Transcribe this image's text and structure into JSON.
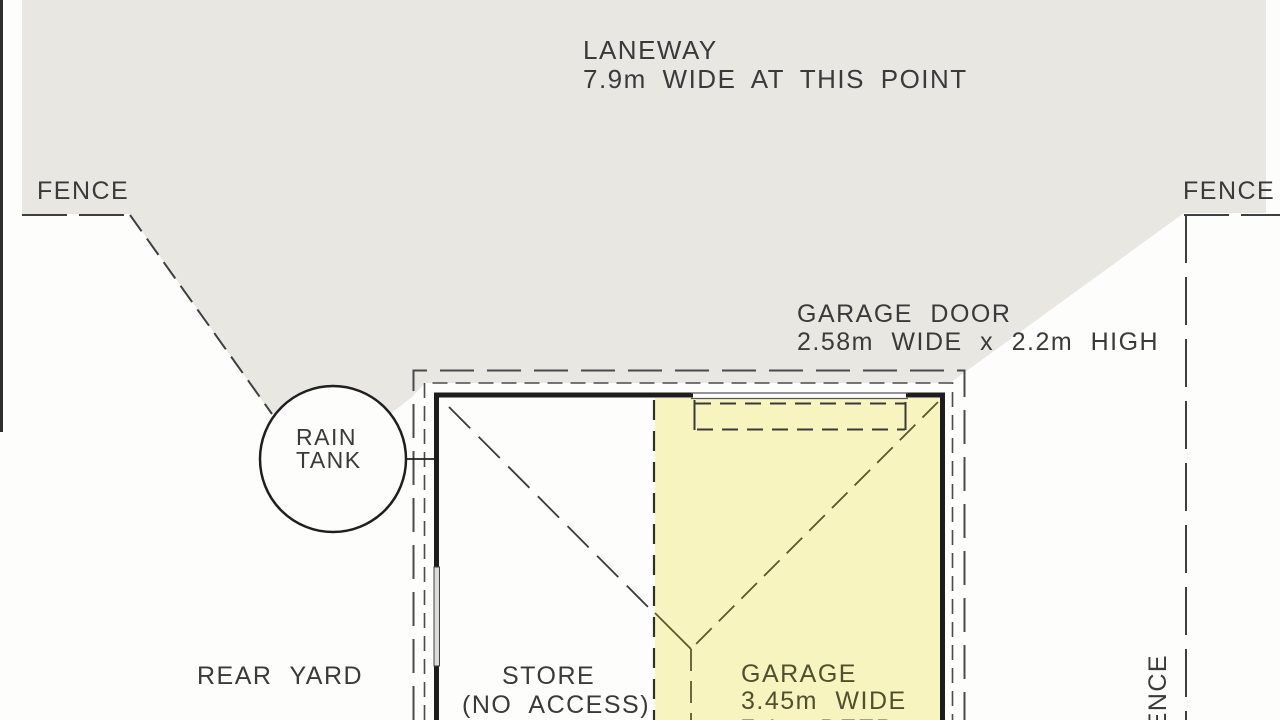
{
  "drawing": {
    "laneway": {
      "title": "LANEWAY",
      "subtitle": "7.9m WIDE AT THIS POINT"
    },
    "fence": {
      "left_label": "FENCE",
      "right_label": "FENCE",
      "right_vertical_label": "FENCE"
    },
    "garage_door": {
      "title": "GARAGE DOOR",
      "dimensions": "2.58m WIDE x 2.2m HIGH"
    },
    "rain_tank": {
      "line1": "RAIN",
      "line2": "TANK"
    },
    "rear_yard": {
      "label": "REAR YARD"
    },
    "store": {
      "line1": "STORE",
      "line2": "(NO ACCESS)"
    },
    "garage": {
      "line1": "GARAGE",
      "line2": "3.45m WIDE",
      "line3": "7.1m DEEP"
    },
    "colors": {
      "laneway_gray": "#e8e7e2",
      "garage_yellow": "#f7f4bf",
      "wall_ink": "#1d1d1d",
      "line_ink": "#3f3f3f",
      "roof_line_olive": "#5a5a2e",
      "text_ink": "#3a3a3a"
    }
  }
}
